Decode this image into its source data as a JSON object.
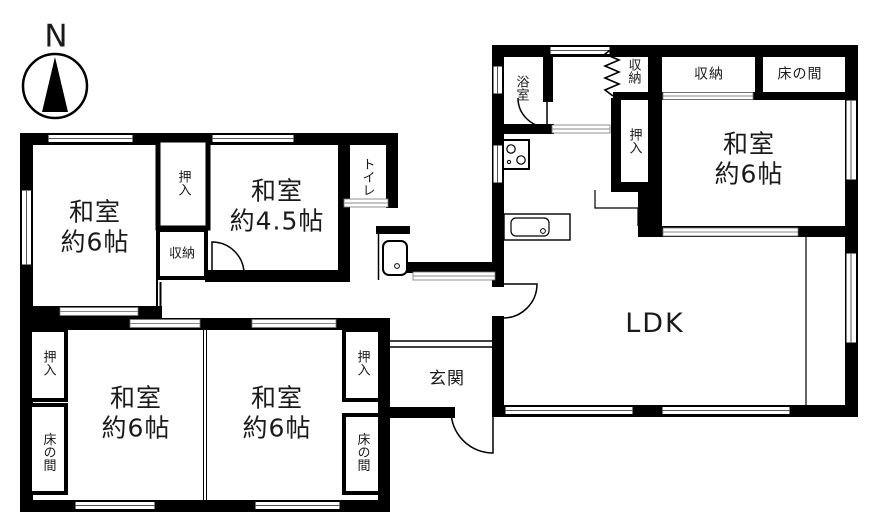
{
  "compass": {
    "north_label": "N"
  },
  "rooms": {
    "nw_washitsu": {
      "name": "和室",
      "size": "約6帖"
    },
    "nw_oshiire": {
      "label": "押入"
    },
    "nw_shuunou": {
      "label": "収納"
    },
    "washitsu_45": {
      "name": "和室",
      "size": "約4.5帖"
    },
    "toilet": {
      "label": "トイレ"
    },
    "sw_oshiire": {
      "label": "押入"
    },
    "sw_tokonoma": {
      "label": "床の間"
    },
    "sw_washitsu_left": {
      "name": "和室",
      "size": "約6帖"
    },
    "sw_washitsu_right": {
      "name": "和室",
      "size": "約6帖"
    },
    "se_oshiire": {
      "label": "押入"
    },
    "se_tokonoma": {
      "label": "床の間"
    },
    "genkan": {
      "label": "玄関"
    },
    "bathroom": {
      "label": "浴室"
    },
    "ne_shuunou_small": {
      "label": "収納"
    },
    "ne_shuunou": {
      "label": "収納"
    },
    "ne_tokonoma": {
      "label": "床の間"
    },
    "ne_oshiire": {
      "label": "押入"
    },
    "ne_washitsu": {
      "name": "和室",
      "size": "約6帖"
    },
    "ldk": {
      "label": "LDK"
    }
  },
  "colors": {
    "wall": "#000000",
    "background": "#ffffff",
    "hatch": "#999999"
  }
}
